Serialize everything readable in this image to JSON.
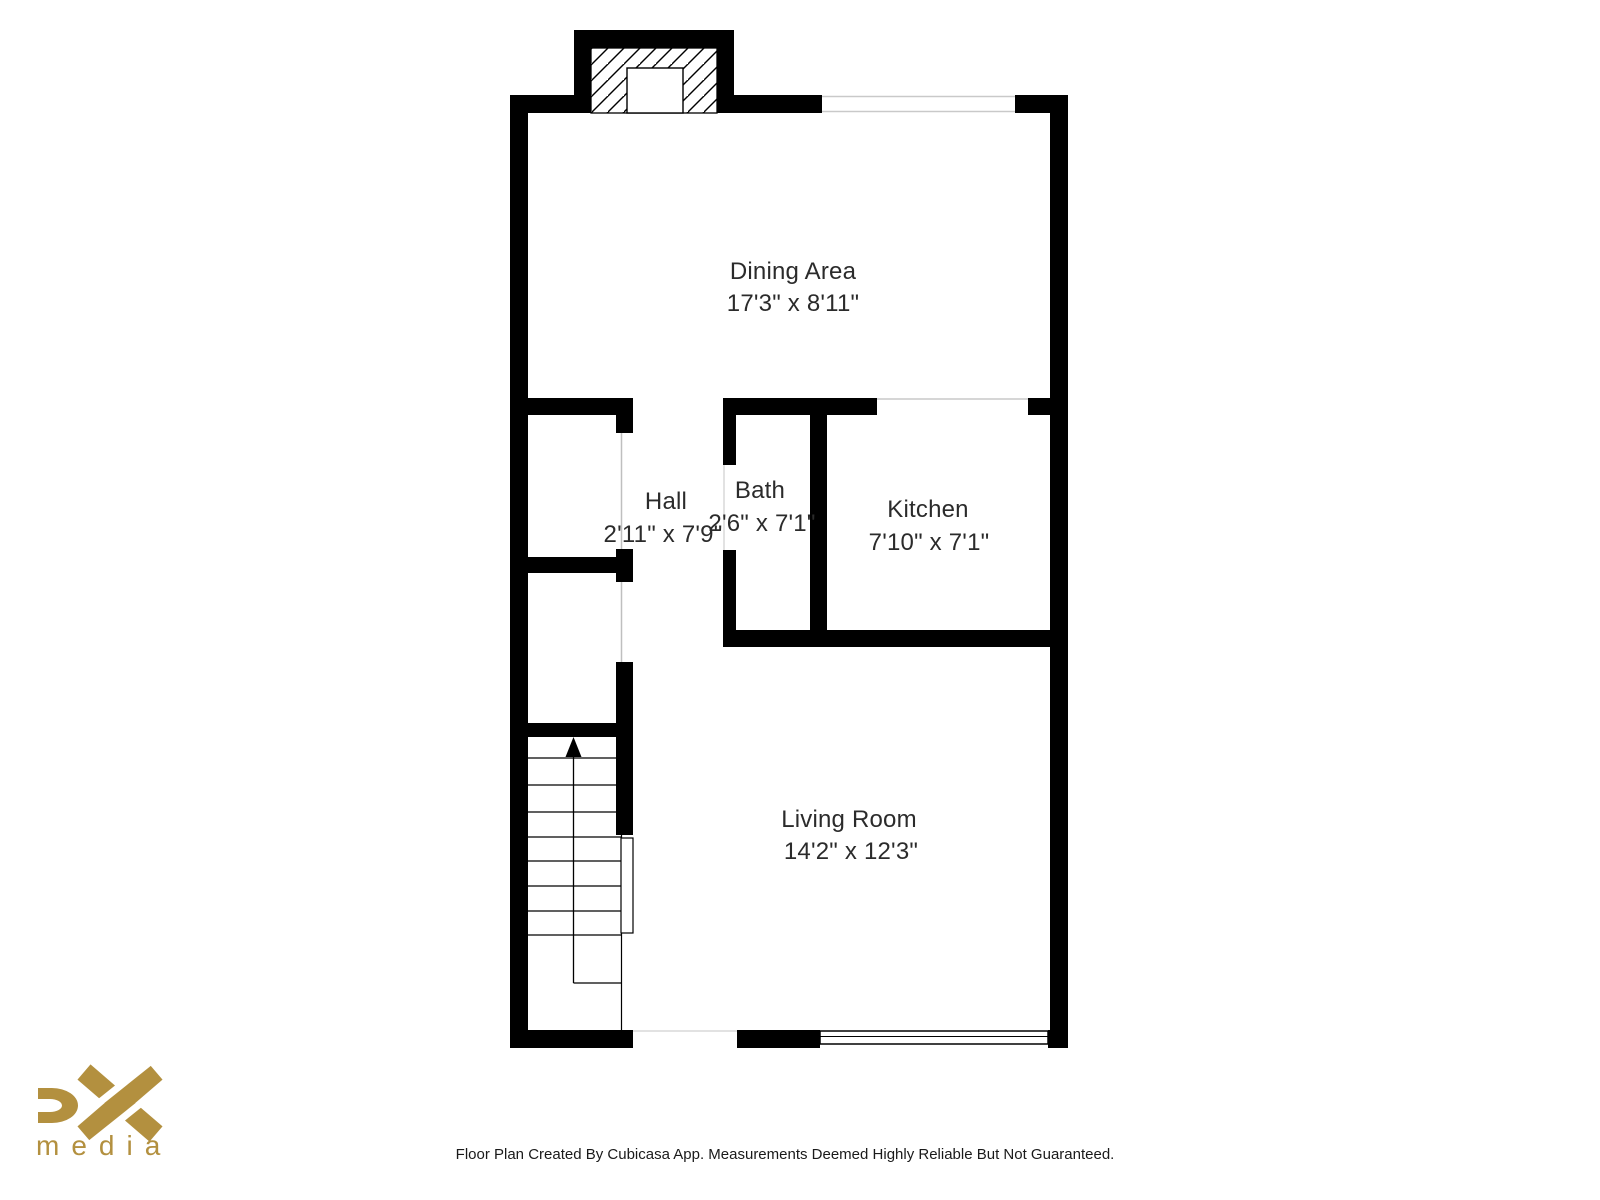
{
  "page": {
    "background_color": "#ffffff"
  },
  "plan": {
    "wall_color": "#000000",
    "rooms": [
      {
        "id": "dining",
        "name": "Dining Area",
        "dimensions": "17'3\" x 8'11\""
      },
      {
        "id": "hall",
        "name": "Hall",
        "dimensions": "2'11\" x 7'9\""
      },
      {
        "id": "bath",
        "name": "Bath",
        "dimensions": "2'6\" x 7'1\""
      },
      {
        "id": "kitchen",
        "name": "Kitchen",
        "dimensions": "7'10\" x 7'1\""
      },
      {
        "id": "living",
        "name": "Living Room",
        "dimensions": "14'2\" x 12'3\""
      }
    ],
    "stairs": {
      "direction": "up"
    }
  },
  "logo": {
    "brand": "DX",
    "subtext": "media",
    "color": "#B3903F"
  },
  "footer": {
    "disclaimer": "Floor Plan Created By Cubicasa App. Measurements Deemed Highly Reliable But Not Guaranteed."
  }
}
